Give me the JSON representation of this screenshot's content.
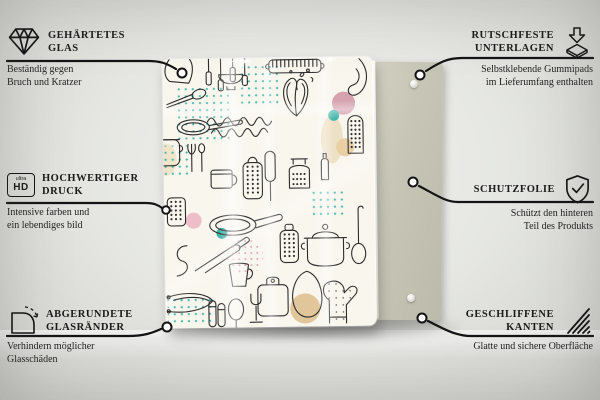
{
  "scene": {
    "background_color": "#e6e7e3",
    "back_panel_color": "#c7c6b6",
    "print_colors": {
      "cream": "#f9f6ee",
      "teal": "#45b5ab",
      "pink": "#eebdca",
      "mauve": "#d6a2b0",
      "tan": "#e3c79b",
      "line": "#2c2c2c"
    },
    "print_motif": "kitchen-utensils-line-doodle"
  },
  "callouts": {
    "top_left": {
      "icon": "diamond-icon",
      "title_line1": "GEHÄRTETES",
      "title_line2": "GLAS",
      "desc_line1": "Beständig gegen",
      "desc_line2": "Bruch und Kratzer"
    },
    "mid_left": {
      "icon": "ultra-hd-icon",
      "icon_text_top": "ultra",
      "icon_text_bottom": "HD",
      "title_line1": "HOCHWERTIGER",
      "title_line2": "DRUCK",
      "desc_line1": "Intensive farben und",
      "desc_line2": "ein lebendiges bild"
    },
    "bottom_left": {
      "icon": "rounded-corner-icon",
      "title_line1": "ABGERUNDETE",
      "title_line2": "GLASRÄNDER",
      "desc_line1": "Verhindern möglicher",
      "desc_line2": "Glasschäden"
    },
    "top_right": {
      "icon": "non-slip-pads-icon",
      "title_line1": "RUTSCHFESTE",
      "title_line2": "UNTERLAGEN",
      "desc_line1": "Selbstklebende Gummipads",
      "desc_line2": "im Lieferumfang enthalten"
    },
    "mid_right": {
      "icon": "shield-check-icon",
      "title_line1": "SCHUTZFOLIE",
      "title_line2": "",
      "desc_line1": "Schützt den hinteren",
      "desc_line2": "Teil des Produkts"
    },
    "bottom_right": {
      "icon": "polished-edges-icon",
      "title_line1": "GESCHLIFFENE",
      "title_line2": "KANTEN",
      "desc_line1": "Glatte und sichere Oberfläche",
      "desc_line2": ""
    }
  }
}
